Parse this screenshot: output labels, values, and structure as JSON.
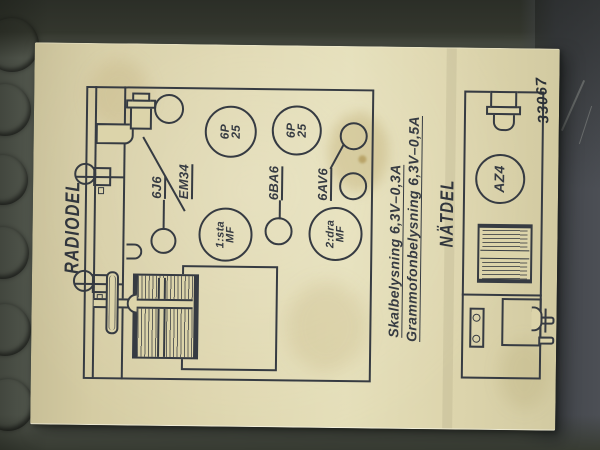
{
  "titles": {
    "radiodel": "RADIODEL",
    "natdel": "NÄTDEL"
  },
  "tube_labels": {
    "mixer": "6J6",
    "magic_eye": "EM34",
    "if_amp": "6BA6",
    "detector": "6AV6"
  },
  "sockets": {
    "output1": {
      "line1": "6P",
      "line2": "25"
    },
    "output2": {
      "line1": "6P",
      "line2": "25"
    },
    "if_can1": {
      "line1": "1:sta",
      "line2": "MF"
    },
    "if_can2": {
      "line1": "2:dra",
      "line2": "MF"
    },
    "rectifier": "AZ4"
  },
  "captions": {
    "dial_lamp": "Skalbelysning 6,3V–0,3A",
    "phono_lamp": "Grammofonbelysning 6,3V–0,5A"
  },
  "drawing_number": "33067",
  "colors": {
    "paper": "#ded6ad",
    "ink": "#363b42",
    "board": "#5a5f55",
    "hole": "#241812"
  }
}
